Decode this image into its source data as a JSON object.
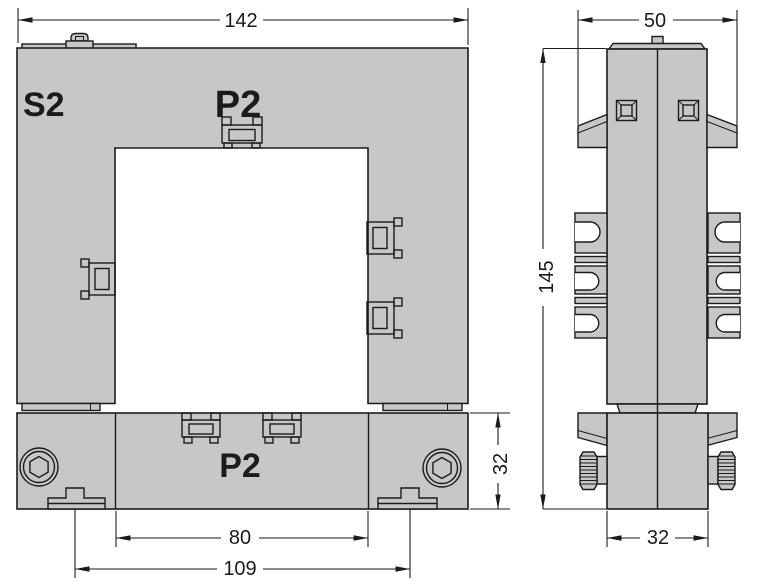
{
  "colors": {
    "body_fill": "#c6c7c9",
    "line": "#1b1b1b",
    "text": "#1b1b1b",
    "window_fill": "#ffffff"
  },
  "front_view": {
    "label_s2": "S2",
    "label_p2_top": "P2",
    "label_p2_bottom": "P2",
    "dim_overall_width": "142",
    "dim_window_width": "80",
    "dim_fixing_centers": "109",
    "dim_bar_height": "32"
  },
  "side_view": {
    "dim_overall_width": "50",
    "dim_overall_height": "145",
    "dim_body_depth": "32"
  }
}
